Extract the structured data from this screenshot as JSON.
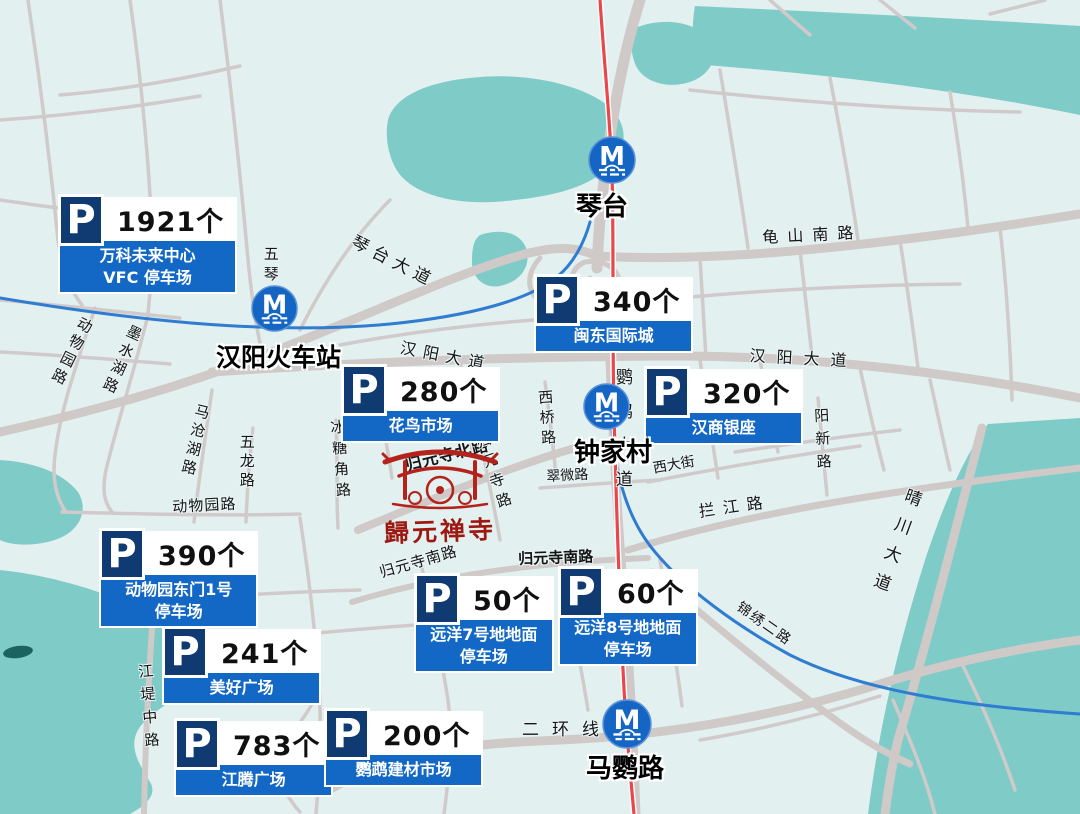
{
  "map": {
    "colors": {
      "background": "#E3F0F0",
      "water": "#7ECBC8",
      "road": "#CFC9C8",
      "metro_line": "#E8474B",
      "waterway": "#2F7CD0",
      "parking_tile": "#0F3A72",
      "parking_bar": "#1268C4",
      "metro_icon": "#1566C4"
    },
    "p_letter": "P",
    "metro_letter": "M"
  },
  "parking_lots": [
    {
      "count": "1921个",
      "name": "万科未来中心\nVFC 停车场"
    },
    {
      "count": "340个",
      "name": "闽东国际城"
    },
    {
      "count": "280个",
      "name": "花鸟市场"
    },
    {
      "count": "320个",
      "name": "汉商银座"
    },
    {
      "count": "390个",
      "name": "动物园东门1号\n停车场"
    },
    {
      "count": "241个",
      "name": "美好广场"
    },
    {
      "count": "50个",
      "name": "远洋7号地地面\n停车场"
    },
    {
      "count": "60个",
      "name": "远洋8号地地面\n停车场"
    },
    {
      "count": "783个",
      "name": "江腾广场"
    },
    {
      "count": "200个",
      "name": "鹦鹉建材市场"
    }
  ],
  "metro_stations": [
    {
      "name": "琴台"
    },
    {
      "name": "汉阳火车站"
    },
    {
      "name": "钟家村"
    },
    {
      "name": "马鹦路"
    }
  ],
  "road_labels": [
    "琴台大道",
    "龟山南路",
    "汉阳大道",
    "汉阳大道",
    "五琴",
    "动物园路",
    "墨水湖路",
    "马沧湖路",
    "五龙路",
    "动物园路",
    "冰糖角路",
    "归元寺北路",
    "归元寺路",
    "西桥路",
    "翠微路",
    "归元寺南路",
    "归元寺南路",
    "鹦鹉大道",
    "西大街",
    "拦江路",
    "显正街",
    "阳新路",
    "晴川大道",
    "锦绣二路",
    "二环线",
    "江堤中路"
  ],
  "landmark": {
    "title": "歸元禅寺"
  }
}
